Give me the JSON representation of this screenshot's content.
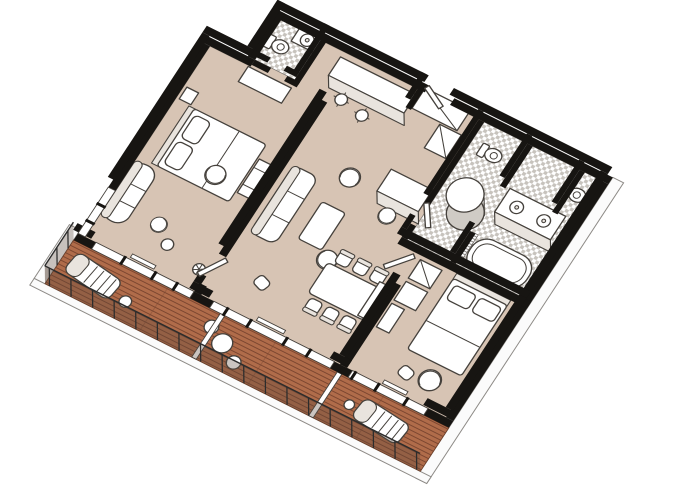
{
  "scene": {
    "kind": "isometric-floor-plan",
    "subject": "two-bedroom suite with wrap balcony",
    "text_labels": []
  },
  "colors": {
    "bg": "#ffffff",
    "floor": "#d7c4b4",
    "wall": "#171512",
    "line": "#45413c",
    "furn": "#ffffff",
    "shade": "#e9e4de",
    "glass": "#ffffff",
    "tile_light": "#ffffff",
    "tile_dark": "#c7c3bd",
    "deck": "#b06c4a",
    "deck_line": "#7c4630",
    "hull": "#fbfbfb",
    "rail": "#5a463a",
    "shower_base": "#cfcbc5"
  },
  "rooms": [
    {
      "id": "guest-bathroom",
      "floor": "checkered-tile",
      "fixtures": [
        "toilet",
        "sink-counter"
      ]
    },
    {
      "id": "entry-bar",
      "floor": "carpet",
      "fixtures": [
        "bar-counter",
        "bar-stool",
        "bar-stool",
        "closet",
        "wardrobe",
        "entry-door"
      ]
    },
    {
      "id": "bedroom-1",
      "floor": "carpet",
      "fixtures": [
        "king-bed",
        "headboard",
        "pillow",
        "pillow",
        "chaise-lounge",
        "armchair",
        "side-chair",
        "side-table",
        "luggage-bench",
        "dresser",
        "nightstand"
      ]
    },
    {
      "id": "living-room",
      "floor": "carpet",
      "fixtures": [
        "sofa",
        "coffee-table",
        "tub-chair",
        "tub-chair",
        "ottoman",
        "plant",
        "desk",
        "desk-chair"
      ]
    },
    {
      "id": "dining-area",
      "floor": "carpet",
      "fixtures": [
        "dining-table",
        "dining-chair",
        "dining-chair",
        "dining-chair",
        "dining-chair",
        "dining-chair",
        "dining-chair",
        "sideboard"
      ]
    },
    {
      "id": "master-bathroom",
      "floor": "checkered-tile",
      "fixtures": [
        "round-shower",
        "double-vanity",
        "sink",
        "sink",
        "bathtub",
        "toilet",
        "toilet"
      ]
    },
    {
      "id": "bedroom-2",
      "floor": "carpet",
      "fixtures": [
        "queen-bed",
        "pillow",
        "pillow",
        "wardrobe",
        "cabinet",
        "armchair",
        "ottoman"
      ]
    },
    {
      "id": "balcony",
      "floor": "wood-deck",
      "fixtures": [
        "sun-lounger",
        "sun-lounger",
        "round-table",
        "deck-chair",
        "deck-chair",
        "side-table",
        "stool",
        "privacy-divider",
        "privacy-divider",
        "railing"
      ]
    }
  ]
}
